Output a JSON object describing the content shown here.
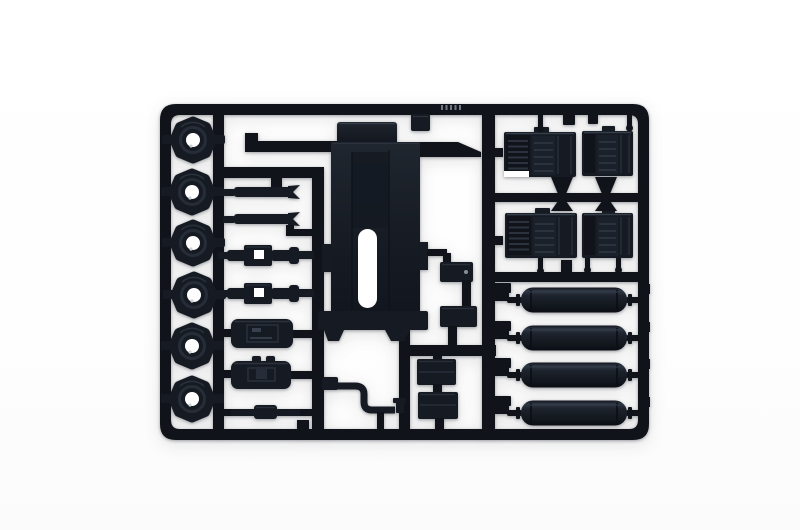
{
  "scene": {
    "title": "Black plastic model kit sprue (injection-molded parts tree) photographed on a seamless white background",
    "object": "model kit sprue with truck detail parts, dark blue-black styrene",
    "background": "seamless white, soft shadow under parts"
  },
  "colors": {
    "bg": "#ffffff",
    "plastic": "#161b23",
    "plastic_light": "#1d232d",
    "plastic_dark": "#10141a",
    "rib": "#2b323e",
    "highlight": "#3a434f",
    "hole": "#ffffff",
    "emboss": "#8a919c"
  },
  "sprue": {
    "frame": "rectangular runner frame with rounded corners and internal vertical runners",
    "parts": [
      {
        "name": "road wheel with center hole",
        "count": 6,
        "location": "left column"
      },
      {
        "name": "leaf-spring strip",
        "count": 2,
        "location": "upper middle-left"
      },
      {
        "name": "axle hub assembly with square opening",
        "count": 2,
        "location": "middle-left"
      },
      {
        "name": "fuel tank (rounded box)",
        "count": 2,
        "location": "lower middle-left"
      },
      {
        "name": "muffler rod",
        "count": 1,
        "location": "bottom middle-left"
      },
      {
        "name": "bent exhaust pipe",
        "count": 1,
        "location": "bottom center"
      },
      {
        "name": "hood / chassis plate with slot",
        "count": 1,
        "location": "center"
      },
      {
        "name": "small mounting block",
        "count": 5,
        "location": "center-right"
      },
      {
        "name": "ribbed grille / step panel",
        "count": 4,
        "location": "upper right 2x2 grid"
      },
      {
        "name": "air tank cylinder",
        "count": 4,
        "location": "lower right stack"
      }
    ]
  }
}
